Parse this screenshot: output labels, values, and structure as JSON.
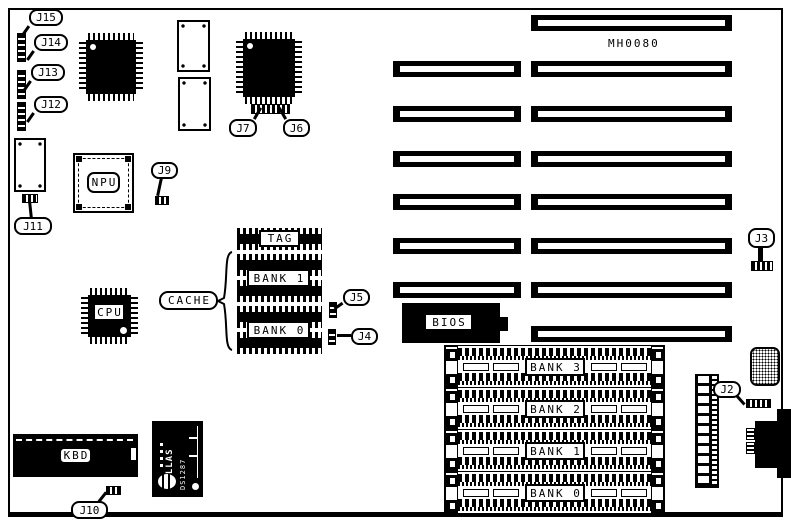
{
  "board": {
    "model_text": "MH0080"
  },
  "callouts": {
    "j2": "J2",
    "j3": "J3",
    "j4": "J4",
    "j5": "J5",
    "j6": "J6",
    "j7": "J7",
    "j9": "J9",
    "j10": "J10",
    "j11": "J11",
    "j12": "J12",
    "j13": "J13",
    "j14": "J14",
    "j15": "J15"
  },
  "chips": {
    "cpu": "CPU",
    "npu": "NPU",
    "kbd": "KBD",
    "bios": "BIOS",
    "dallas_brand": "DALLAS",
    "dallas_part": "DS1287"
  },
  "cache": {
    "group_label": "CACHE",
    "tag_label": "TAG",
    "bank1_label": "BANK 1",
    "bank0_label": "BANK 0"
  },
  "memory": {
    "banks": [
      {
        "label": "BANK 3"
      },
      {
        "label": "BANK 2"
      },
      {
        "label": "BANK 1"
      },
      {
        "label": "BANK 0"
      }
    ]
  }
}
